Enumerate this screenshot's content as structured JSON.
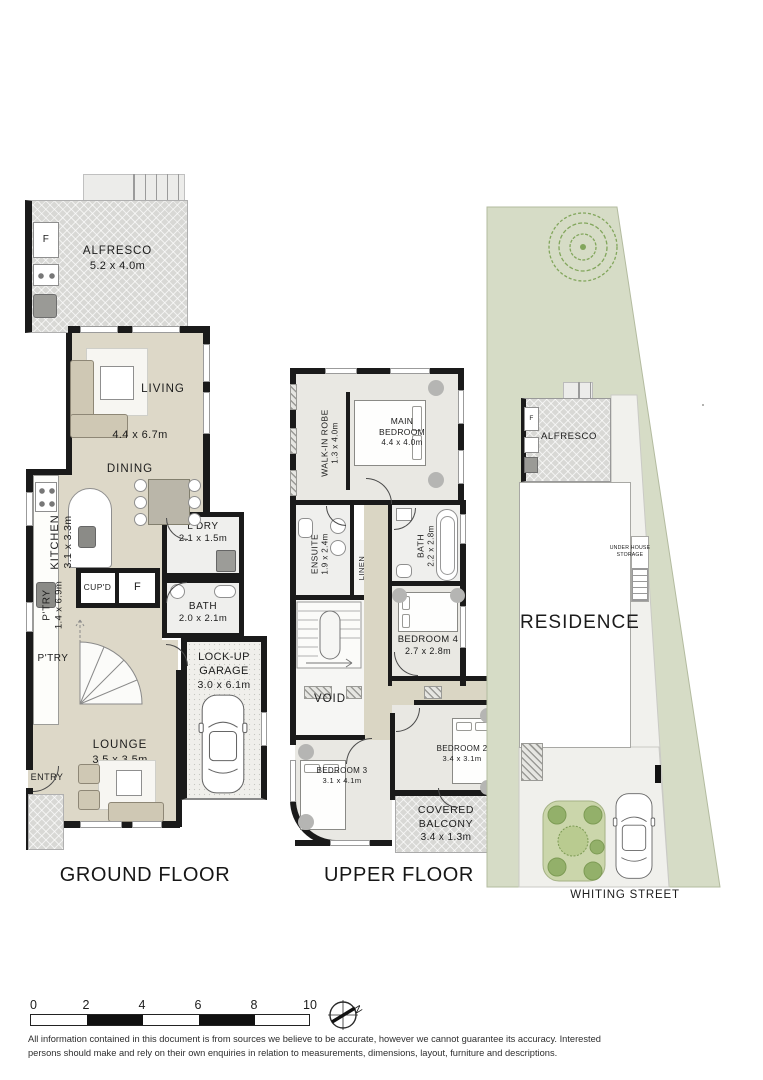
{
  "ground_floor": {
    "title": "GROUND FLOOR",
    "rooms": {
      "alfresco": {
        "name": "ALFRESCO",
        "dim": "5.2 x 4.0m"
      },
      "alfresco_fridge": {
        "name": "F"
      },
      "living": {
        "name": "LIVING",
        "dim": "4.4 x 6.7m"
      },
      "dining": {
        "name": "DINING"
      },
      "kitchen": {
        "name": "KITCHEN",
        "dim": "3.1 x 3.3m"
      },
      "pantry": {
        "name": "P'TRY",
        "dim": "1.4 x 6.9m"
      },
      "pantry2": {
        "name": "P'TRY"
      },
      "cupboard": {
        "name": "CUP'D"
      },
      "fridge": {
        "name": "F"
      },
      "laundry": {
        "name": "L'DRY",
        "dim": "2.1 x 1.5m"
      },
      "bath": {
        "name": "BATH",
        "dim": "2.0 x 2.1m"
      },
      "garage": {
        "name": "LOCK-UP GARAGE",
        "dim": "3.0 x 6.1m"
      },
      "lounge": {
        "name": "LOUNGE",
        "dim": "3.5 x 3.5m"
      },
      "entry": {
        "name": "ENTRY"
      }
    }
  },
  "upper_floor": {
    "title": "UPPER FLOOR",
    "rooms": {
      "walk_in_robe": {
        "name": "WALK-IN ROBE",
        "dim": "1.3 x 4.0m"
      },
      "main_bedroom": {
        "name": "MAIN BEDROOM",
        "dim": "4.4 x 4.0m"
      },
      "ensuite": {
        "name": "ENSUITE",
        "dim": "1.9 x 2.4m"
      },
      "linen": {
        "name": "LINEN"
      },
      "bath": {
        "name": "BATH",
        "dim": "2.2 x 2.8m"
      },
      "bedroom4": {
        "name": "BEDROOM 4",
        "dim": "2.7 x 2.8m"
      },
      "void": {
        "name": "VOID"
      },
      "bedroom3": {
        "name": "BEDROOM 3",
        "dim": "3.1 x 4.1m"
      },
      "bedroom2": {
        "name": "BEDROOM 2",
        "dim": "3.4 x 3.1m"
      },
      "covered_balcony": {
        "name": "COVERED BALCONY",
        "dim": "3.4 x 1.3m"
      }
    }
  },
  "site_plan": {
    "residence": "RESIDENCE",
    "alfresco": "ALFRESCO",
    "alfresco_fridge": "F",
    "water_tank": "WT",
    "under_house_storage": "UNDER HOUSE STORAGE",
    "street": "WHITING STREET"
  },
  "scale_bar": {
    "ticks": [
      "0",
      "2",
      "4",
      "6",
      "8",
      "10"
    ]
  },
  "north": {
    "label": "N"
  },
  "disclaimer": {
    "line1": "All information contained in this document is from sources we believe to be accurate, however we cannot guarantee its accuracy. Interested",
    "line2": "persons should make and rely on their own enquiries in relation to measurements, dimensions, layout, furniture and descriptions."
  },
  "colors": {
    "wall": "#1a1a1a",
    "floor_beige": "#ddd8c8",
    "floor_grey": "#e9e8e3",
    "wet_area": "#efefed",
    "paving": "#d8d8d5",
    "site_green": "#d6dcc6",
    "tree_green": "#82a65c"
  }
}
